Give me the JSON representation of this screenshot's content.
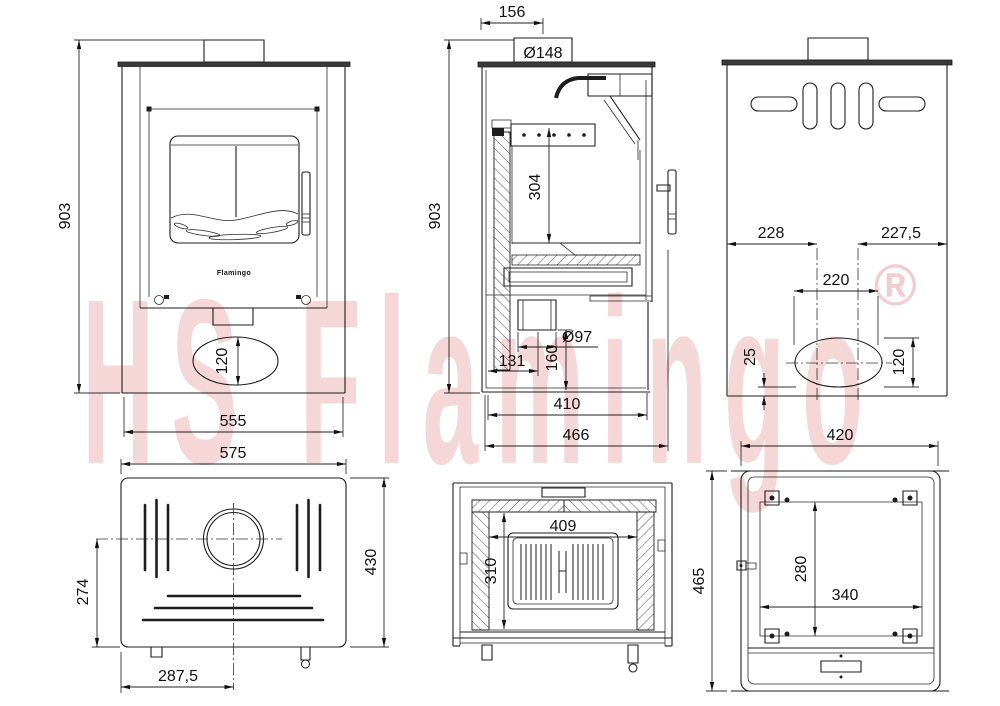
{
  "watermark": {
    "text": "HS Flamingo",
    "registered": "®"
  },
  "door_logo": "Flamingo",
  "colors": {
    "watermark_pink": "#f6d7d7",
    "line": "#1d1d1d"
  },
  "dims": {
    "front": {
      "height": "903",
      "width": "555",
      "ash_door_height": "120"
    },
    "side": {
      "flue_center_offset": "156",
      "flue_diameter": "Ø148",
      "height": "903",
      "firebox_depth": "304",
      "air_inlet_diameter": "Ø97",
      "air_inlet_center_from_back": "131",
      "air_inlet_center_height": "160",
      "base_depth": "410",
      "overall_depth": "466"
    },
    "back": {
      "left_to_outlet": "228",
      "outlet_to_right": "227,5",
      "outlet_width": "220",
      "outlet_bottom_offset": "25",
      "outlet_height": "120"
    },
    "top": {
      "width": "575",
      "depth": "430",
      "flue_center_from_front": "274",
      "flue_center_from_left": "287,5"
    },
    "section_front": {
      "firebox_width": "409",
      "firebox_height": "310"
    },
    "bottom": {
      "width": "420",
      "depth": "465",
      "inner_depth": "280",
      "inner_width": "340"
    }
  }
}
